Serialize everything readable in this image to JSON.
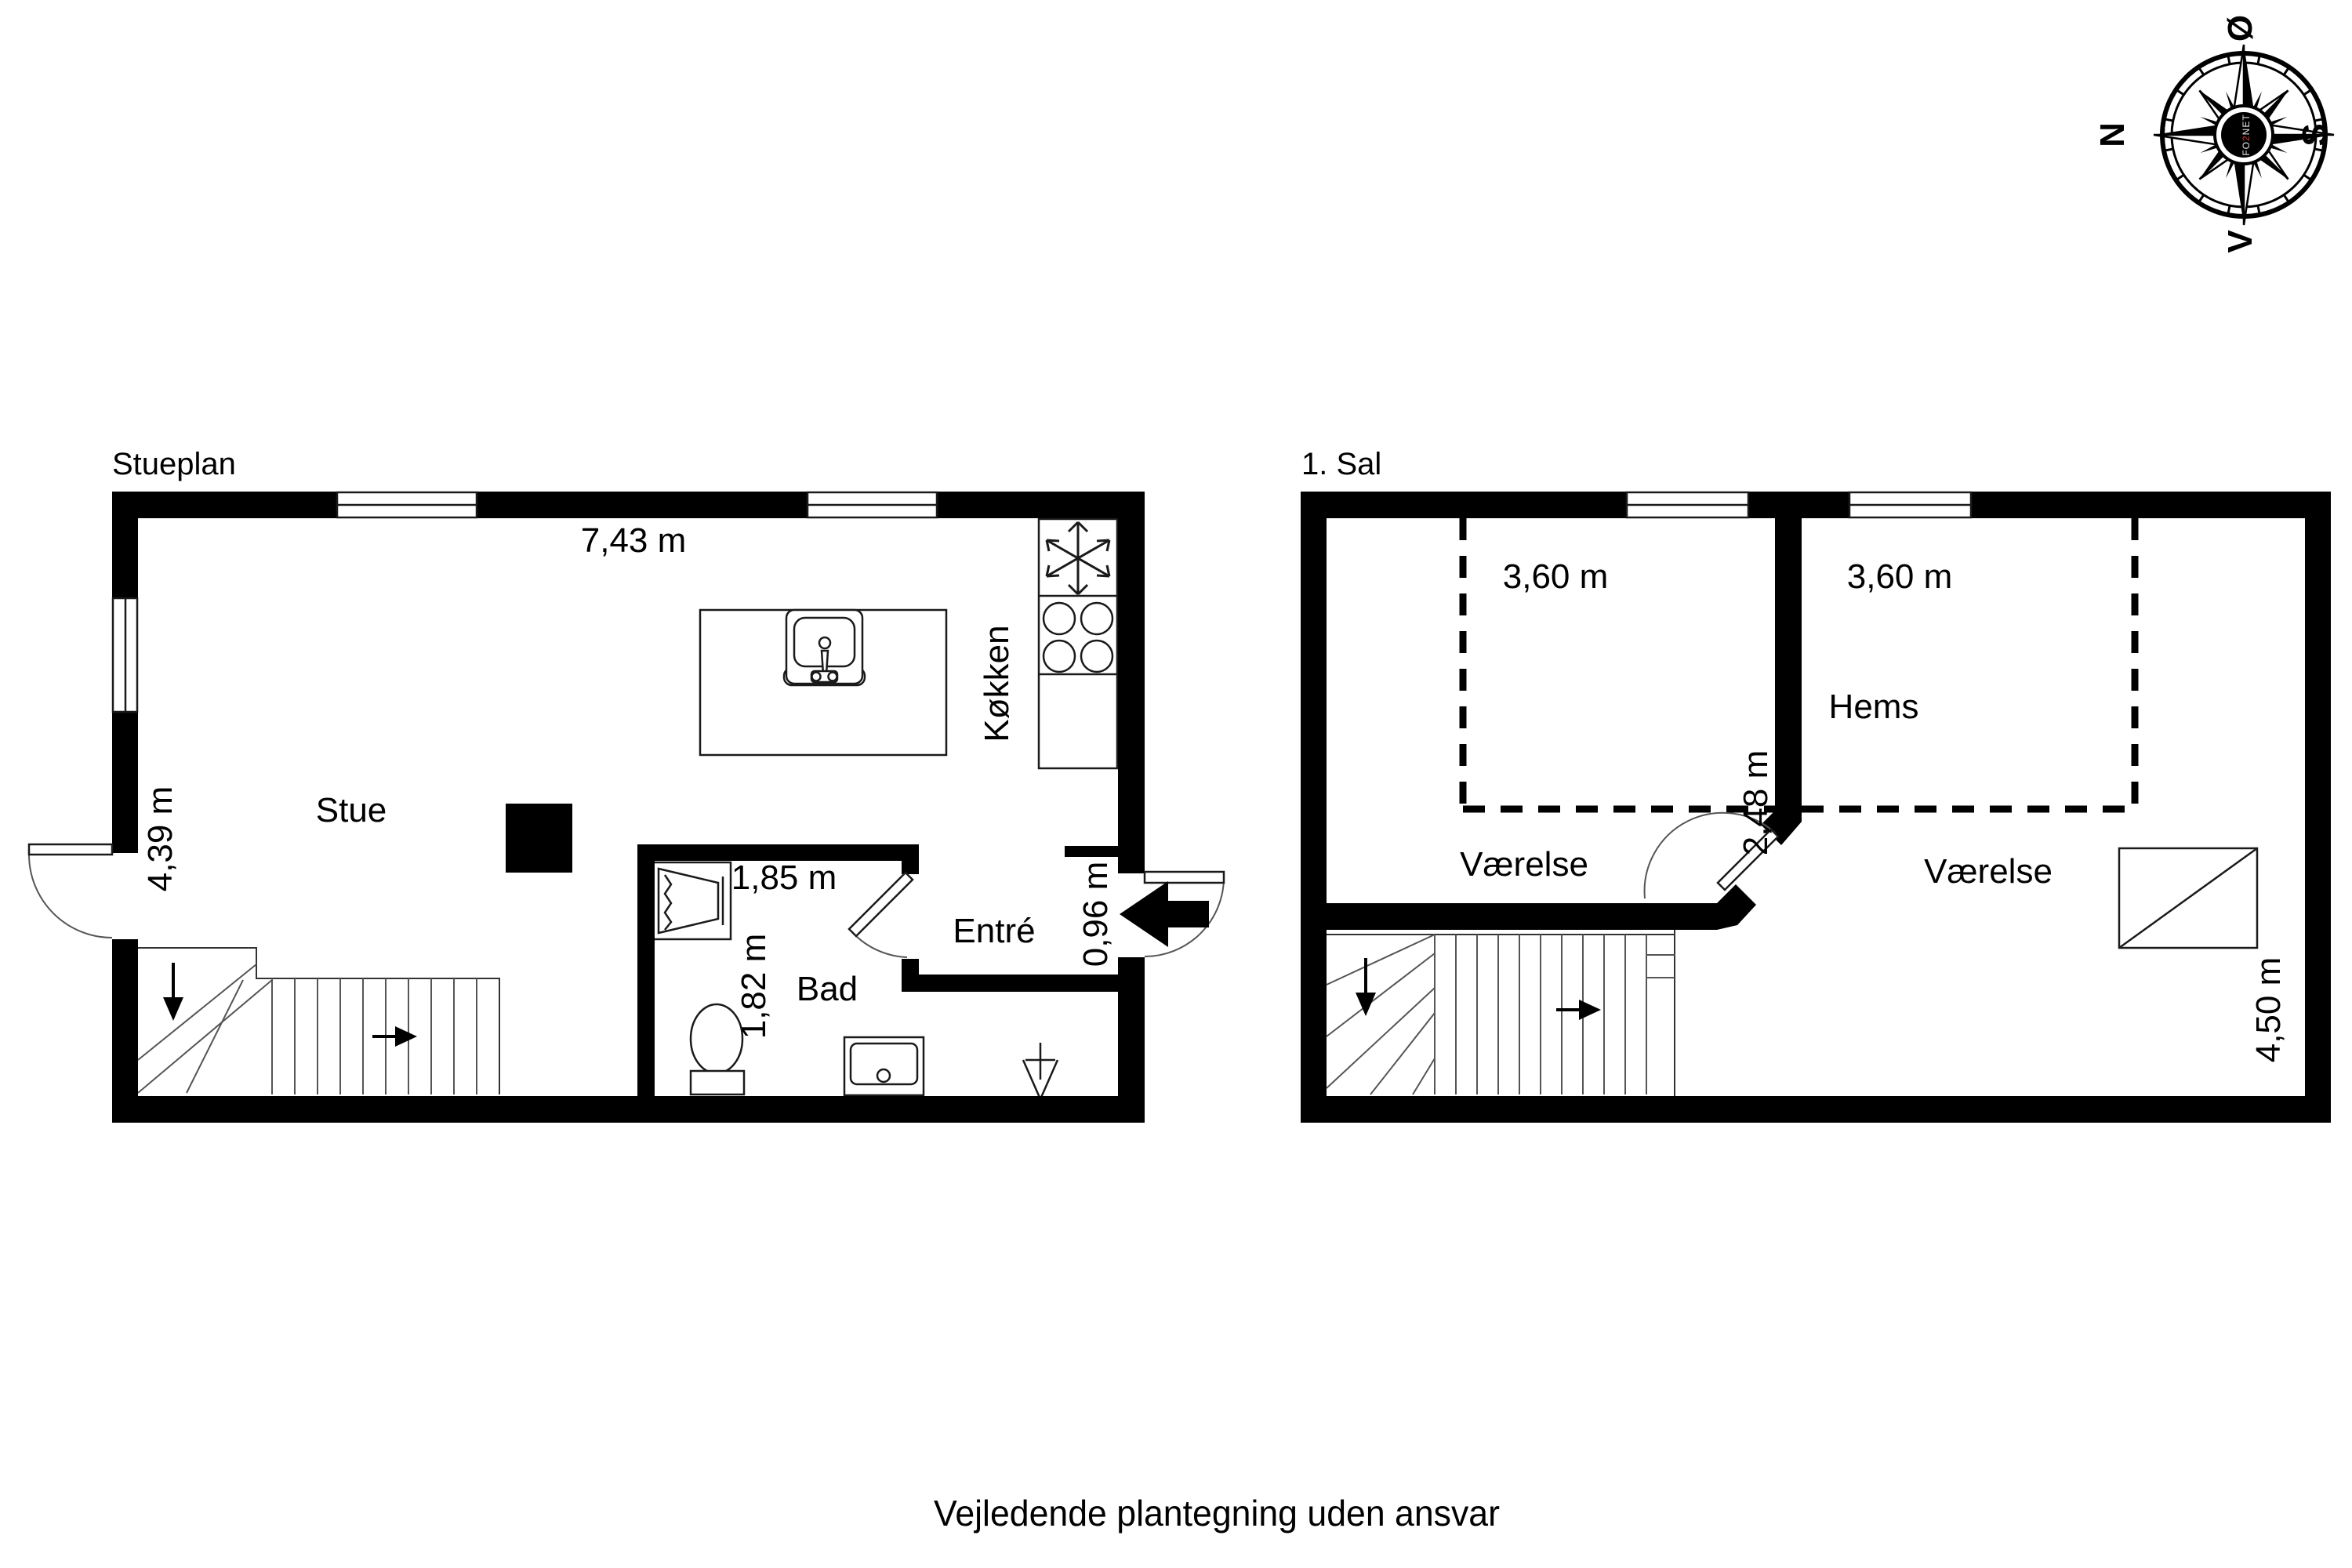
{
  "footer": {
    "disclaimer": "Vejledende plantegning uden ansvar"
  },
  "compass": {
    "north": "N",
    "east": "Ø",
    "south": "S",
    "west": "V",
    "logo_prefix": "FO",
    "logo_digit": "2",
    "logo_suffix": "NET"
  },
  "ground_floor": {
    "title": "Stueplan",
    "rooms": {
      "living": "Stue",
      "kitchen": "Køkken",
      "bath": "Bad",
      "entry": "Entré"
    },
    "dimensions": {
      "width": "7,43 m",
      "depth": "4,39 m",
      "bath_width": "1,85 m",
      "bath_depth": "1,82 m",
      "entry_depth": "0,96 m"
    }
  },
  "first_floor": {
    "title": "1. Sal",
    "rooms": {
      "room_left": "Værelse",
      "room_right": "Værelse",
      "loft": "Hems"
    },
    "dimensions": {
      "left_width": "3,60 m",
      "right_width": "3,60 m",
      "loft_depth": "2,48 m",
      "room_depth": "4,50 m"
    }
  }
}
